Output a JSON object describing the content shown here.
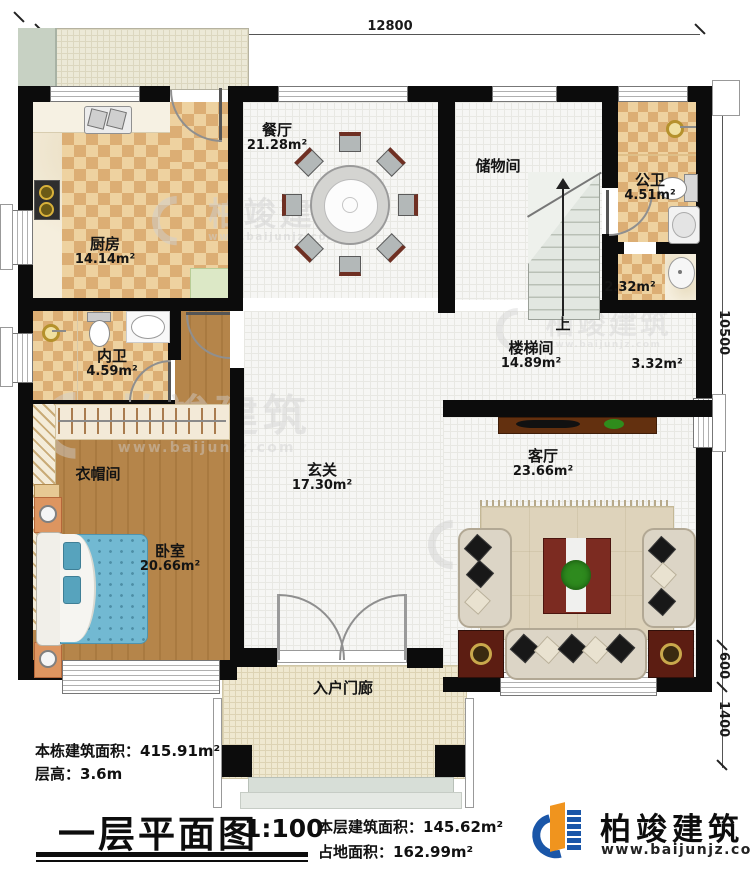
{
  "dimensions": {
    "top_width": "12800",
    "right_total": "10500",
    "right_mid": "600",
    "right_bottom": "1400"
  },
  "rooms": {
    "kitchen": {
      "name": "厨房",
      "area": "14.14m²"
    },
    "dining": {
      "name": "餐厅",
      "area": "21.28m²"
    },
    "storage": {
      "name": "储物间"
    },
    "public_bath": {
      "name": "公卫",
      "area": "4.51m²"
    },
    "wash_area": {
      "area": "2.32m²"
    },
    "inner_bath": {
      "name": "内卫",
      "area": "4.59m²"
    },
    "cloakroom": {
      "name": "衣帽间"
    },
    "bedroom": {
      "name": "卧室",
      "area": "20.66m²"
    },
    "foyer": {
      "name": "玄关",
      "area": "17.30m²"
    },
    "stair_hall": {
      "name": "楼梯间",
      "area": "14.89m²"
    },
    "stair_side": {
      "area": "3.32m²"
    },
    "living": {
      "name": "客厅",
      "area": "23.66m²"
    },
    "porch": {
      "name": "入户门廊"
    },
    "stairs_up": "上"
  },
  "notes": {
    "building_area_label": "本栋建筑面积：",
    "building_area_value": "415.91m²",
    "floor_height_label": "层高：",
    "floor_height_value": "3.6m",
    "floor_area_label": "本层建筑面积：",
    "floor_area_value": "145.62m²",
    "footprint_label": "占地面积：",
    "footprint_value": "162.99m²"
  },
  "title_block": {
    "title": "一层平面图",
    "scale": "1:100"
  },
  "brand": {
    "name": "柏竣建筑",
    "url": "www.baijunjz.com"
  },
  "watermark": {
    "name": "柏竣建筑",
    "url": "www.baijunjz.com"
  },
  "colors": {
    "wall": "#0c0c0c",
    "brand_blue": "#1a56a8",
    "brand_orange": "#f0941e",
    "bed_blue": "#72b9d2",
    "checker_tan": "#dcae74",
    "wood_brown": "#b5854a"
  }
}
